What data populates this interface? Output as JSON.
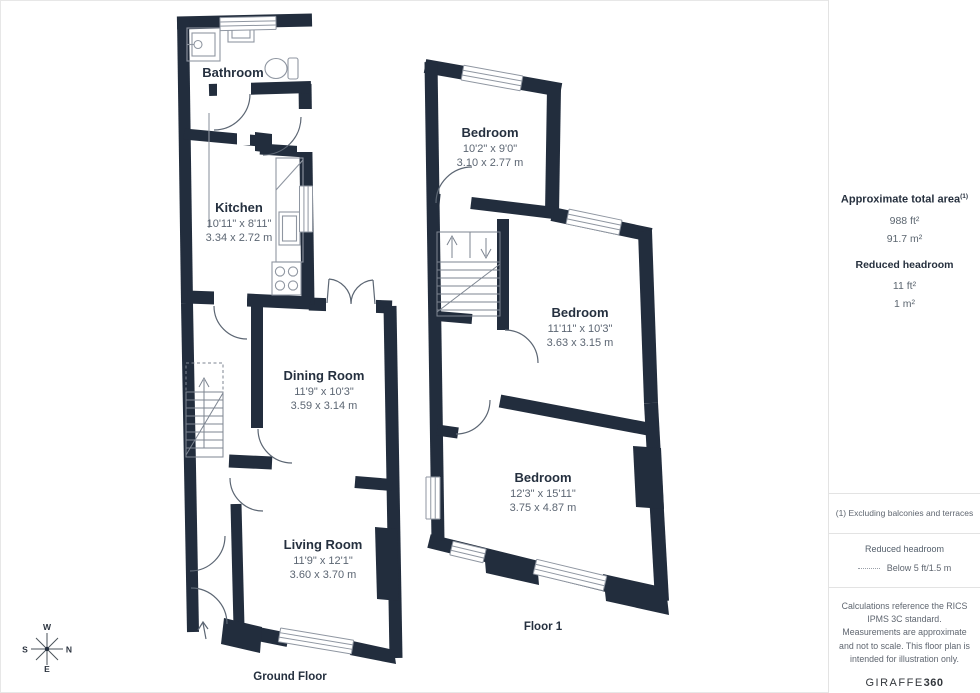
{
  "ground_floor": {
    "label": "Ground Floor",
    "bathroom": {
      "name": "Bathroom"
    },
    "kitchen": {
      "name": "Kitchen",
      "imperial": "10'11\" x 8'11\"",
      "metric": "3.34 x 2.72 m"
    },
    "dining": {
      "name": "Dining Room",
      "imperial": "11'9\" x 10'3\"",
      "metric": "3.59 x 3.14 m"
    },
    "living": {
      "name": "Living Room",
      "imperial": "11'9\" x 12'1\"",
      "metric": "3.60 x 3.70 m"
    }
  },
  "floor_1": {
    "label": "Floor 1",
    "bedroom_small": {
      "name": "Bedroom",
      "imperial": "10'2\" x 9'0\"",
      "metric": "3.10 x 2.77 m"
    },
    "bedroom_mid": {
      "name": "Bedroom",
      "imperial": "11'11\" x 10'3\"",
      "metric": "3.63 x 3.15 m"
    },
    "bedroom_large": {
      "name": "Bedroom",
      "imperial": "12'3\" x 15'11\"",
      "metric": "3.75 x 4.87 m"
    }
  },
  "compass": {
    "top": "W",
    "right": "N",
    "left": "S",
    "bottom": "E"
  },
  "sidebar": {
    "total_area_title": "Approximate total area",
    "total_area_superscript": "(1)",
    "total_area_ft": "988 ft²",
    "total_area_m": "91.7 m²",
    "reduced_headroom_title": "Reduced headroom",
    "reduced_headroom_ft": "11 ft²",
    "reduced_headroom_m": "1 m²",
    "footnote": "(1) Excluding balconies and terraces",
    "legend_title": "Reduced headroom",
    "legend_value": "Below 5 ft/1.5 m",
    "disclaimer": "Calculations reference the RICS IPMS 3C standard. Measurements are approximate and not to scale. This floor plan is intended for illustration only.",
    "brand": "GIRAFFE",
    "brand_bold": "360"
  },
  "colors": {
    "wall": "#222d3d",
    "fixture": "#8f96a1",
    "arc": "#5c6673",
    "stairs": "#7d8591"
  }
}
